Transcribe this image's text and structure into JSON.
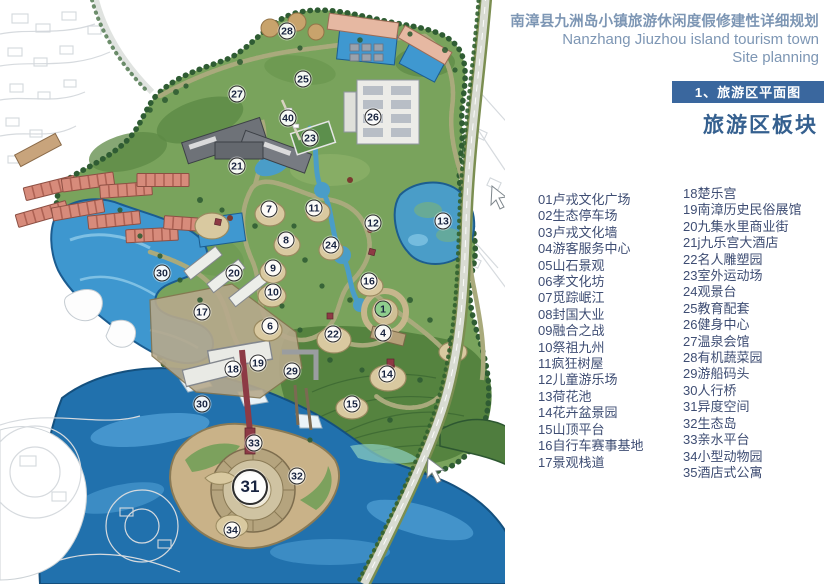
{
  "header": {
    "title_cn": "南漳县九洲岛小镇旅游休闲度假修建性详细规划",
    "title_en_line1": "Nanzhang Jiuzhou island tourism town",
    "title_en_line2": "Site planning",
    "section_label": "1、旅游区平面图",
    "section_title": "旅游区板块"
  },
  "colors": {
    "section_bar_bg": "#3a679e",
    "section_bar_text": "#ffffff",
    "title_text": "#7d96b4",
    "section_title_text": "#35608f",
    "legend_text": "#3e4d73",
    "water_deep": "#2171ad",
    "water_bright": "#3e97cf",
    "greenery": "#79a35c",
    "tree_band": "#2d5731",
    "marker_accent": "#8fce8d"
  },
  "legend": {
    "column1": [
      "01卢戎文化广场",
      "02生态停车场",
      "03卢戎文化墙",
      "04游客服务中心",
      "05山石景观",
      "06孝文化坊",
      "07觅踪岷江",
      "08封国大业",
      "09融合之战",
      "10祭祖九州",
      "11疯狂树屋",
      "12儿童游乐场",
      "13荷花池",
      "14花卉盆景园",
      "15山顶平台",
      "16自行车赛事基地",
      "17景观栈道"
    ],
    "column2": [
      "18楚乐宫",
      "19南漳历史民俗展馆",
      "20九集水里商业街",
      "21j九乐宫大酒店",
      "22名人雕塑园",
      "23室外运动场",
      "24观景台",
      "25教育配套",
      "26健身中心",
      "27温泉会馆",
      "28有机蔬菜园",
      "29游船码头",
      "30人行桥",
      "31异度空间",
      "32生态岛",
      "33亲水平台",
      "34小型动物园",
      "35酒店式公寓"
    ]
  },
  "map": {
    "markers": [
      {
        "label": "28",
        "x": 287,
        "y": 31
      },
      {
        "label": "25",
        "x": 303,
        "y": 79
      },
      {
        "label": "27",
        "x": 237,
        "y": 94
      },
      {
        "label": "40",
        "x": 288,
        "y": 118
      },
      {
        "label": "26",
        "x": 373,
        "y": 117
      },
      {
        "label": "23",
        "x": 310,
        "y": 138
      },
      {
        "label": "21",
        "x": 237,
        "y": 166
      },
      {
        "label": "7",
        "x": 269,
        "y": 209
      },
      {
        "label": "11",
        "x": 314,
        "y": 208
      },
      {
        "label": "12",
        "x": 373,
        "y": 223
      },
      {
        "label": "13",
        "x": 443,
        "y": 221
      },
      {
        "label": "8",
        "x": 286,
        "y": 240
      },
      {
        "label": "24",
        "x": 331,
        "y": 245
      },
      {
        "label": "9",
        "x": 273,
        "y": 268
      },
      {
        "label": "20",
        "x": 234,
        "y": 273
      },
      {
        "label": "30",
        "x": 162,
        "y": 273
      },
      {
        "label": "16",
        "x": 369,
        "y": 281
      },
      {
        "label": "10",
        "x": 273,
        "y": 292
      },
      {
        "label": "1",
        "x": 383,
        "y": 309,
        "accent": true
      },
      {
        "label": "17",
        "x": 202,
        "y": 312
      },
      {
        "label": "6",
        "x": 270,
        "y": 326
      },
      {
        "label": "22",
        "x": 333,
        "y": 334
      },
      {
        "label": "4",
        "x": 383,
        "y": 333
      },
      {
        "label": "19",
        "x": 258,
        "y": 363
      },
      {
        "label": "18",
        "x": 233,
        "y": 369
      },
      {
        "label": "29",
        "x": 292,
        "y": 371
      },
      {
        "label": "14",
        "x": 387,
        "y": 374
      },
      {
        "label": "15",
        "x": 352,
        "y": 404
      },
      {
        "label": "30",
        "x": 202,
        "y": 404
      },
      {
        "label": "33",
        "x": 254,
        "y": 443
      },
      {
        "label": "32",
        "x": 297,
        "y": 476
      },
      {
        "label": "31",
        "x": 250,
        "y": 487,
        "size": "lg"
      },
      {
        "label": "34",
        "x": 232,
        "y": 530
      }
    ]
  }
}
